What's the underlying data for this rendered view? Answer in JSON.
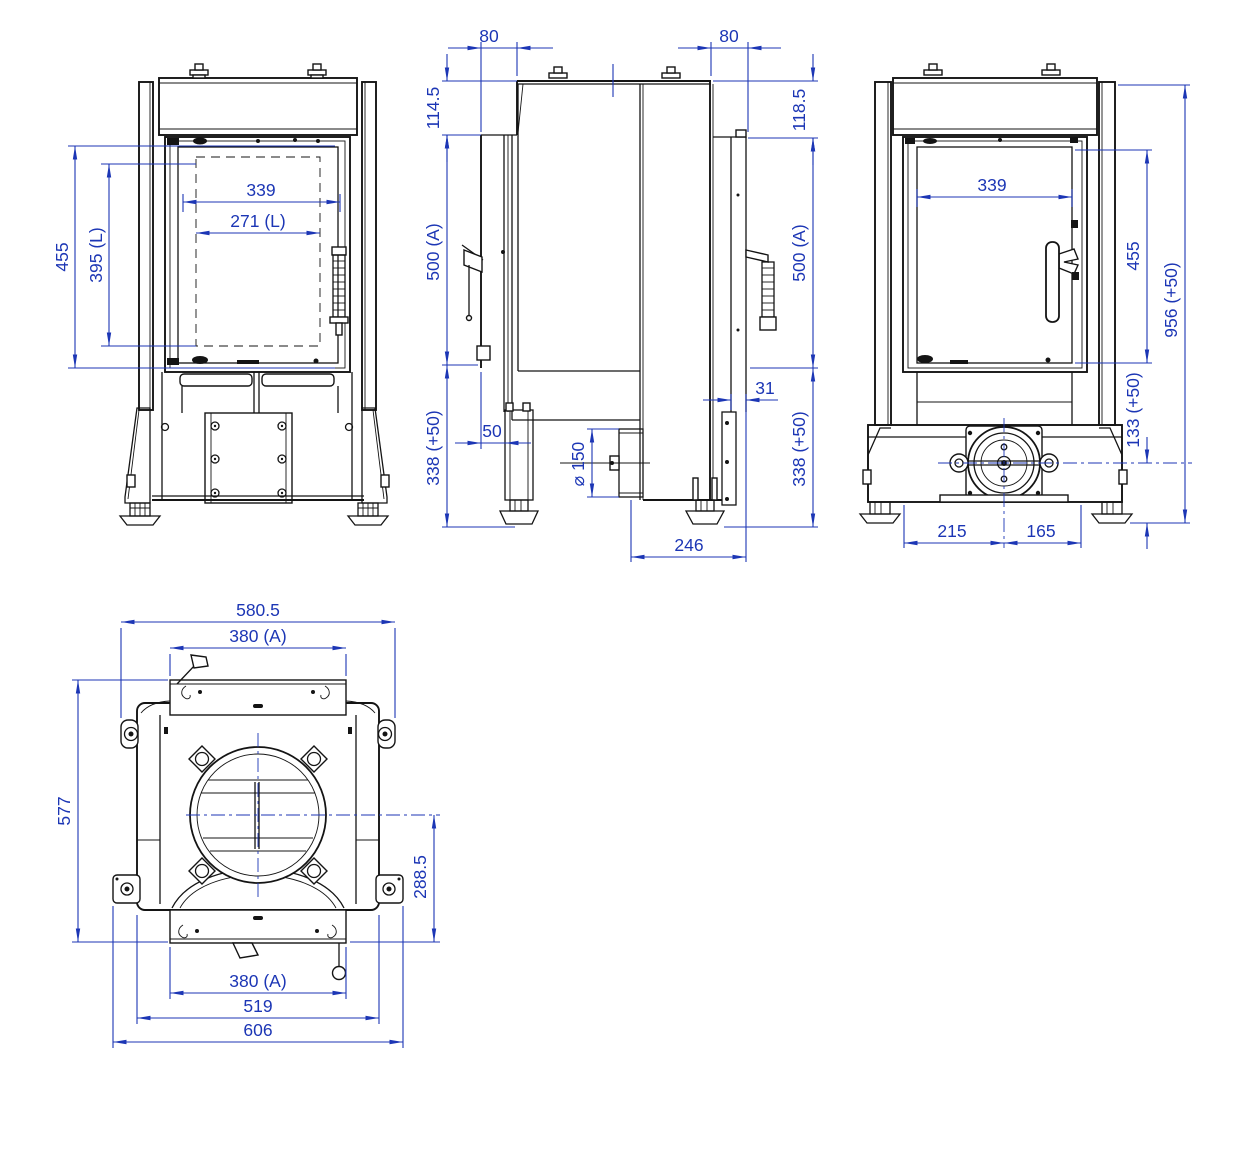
{
  "meta": {
    "type": "multi-view technical dimension drawing",
    "subject": "fireplace insert stove",
    "units": "mm",
    "background_color": "#ffffff",
    "line_color": "#141414",
    "dimension_color": "#1c36b5"
  },
  "views": {
    "front": {
      "dims": {
        "frame_height": "455",
        "light_height": "395 (L)",
        "glass_width": "339",
        "light_width": "271 (L)"
      }
    },
    "side": {
      "dims": {
        "top_inset_front": "80",
        "top_inset_rear": "80",
        "hood_front": "114.5",
        "hood_rear": "118.5",
        "body_front": "500 (A)",
        "body_rear": "500 (A)",
        "base_front": "338 (+50)",
        "base_rear": "338 (+50)",
        "leg_offset": "50",
        "flue_diameter": "⌀ 150",
        "rear_panel_thickness": "31",
        "base_depth": "246"
      }
    },
    "rear": {
      "dims": {
        "glass_width": "339",
        "door_height": "455",
        "total_height": "956 (+50)",
        "intake_center_height": "133 (+50)",
        "intake_left": "215",
        "intake_right": "165"
      }
    },
    "top": {
      "dims": {
        "top_width": "580.5",
        "frame_width_front": "380 (A)",
        "depth": "577",
        "flue_center_offset": "288.5",
        "frame_width_rear": "380 (A)",
        "body_width": "519",
        "overall_width": "606"
      }
    }
  }
}
